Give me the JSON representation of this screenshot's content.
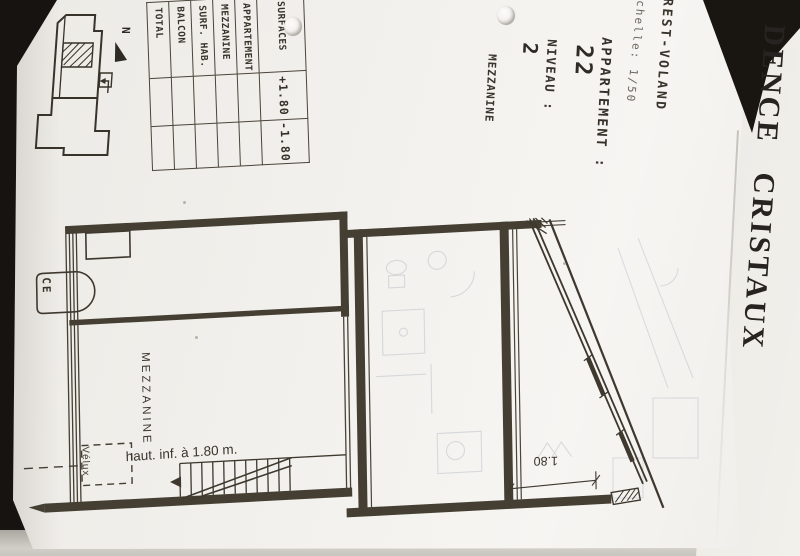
{
  "sheet": {
    "back_title": "DENCE CRISTAUX",
    "location": "REST-VOLAND",
    "scale_note": "chelle: 1/50",
    "apartment_label": "APPARTEMENT :",
    "apartment_number": "22",
    "level_label": "NIVEAU :",
    "level_number": "2",
    "level_type": "MEZZANINE"
  },
  "surface_table": {
    "header": "SURFACES",
    "sub_headers": [
      "+1.80",
      "-1.80"
    ],
    "row_labels": [
      "APPARTEMENT",
      "MEZZANINE",
      "SURF. HAB.",
      "BALCON",
      "TOTAL"
    ]
  },
  "plan": {
    "room_label": "MEZZANINE",
    "height_note": "haut. inf. à 1.80 m.",
    "skylight_label": "Vélux",
    "water_heater_label": "CE",
    "dimension_value": "1.80",
    "north_letter": "N"
  },
  "colors": {
    "background": "#17130f",
    "paper": "#f3f1ed",
    "ink": "#3b362d",
    "ghost": "#9aa2b2"
  }
}
